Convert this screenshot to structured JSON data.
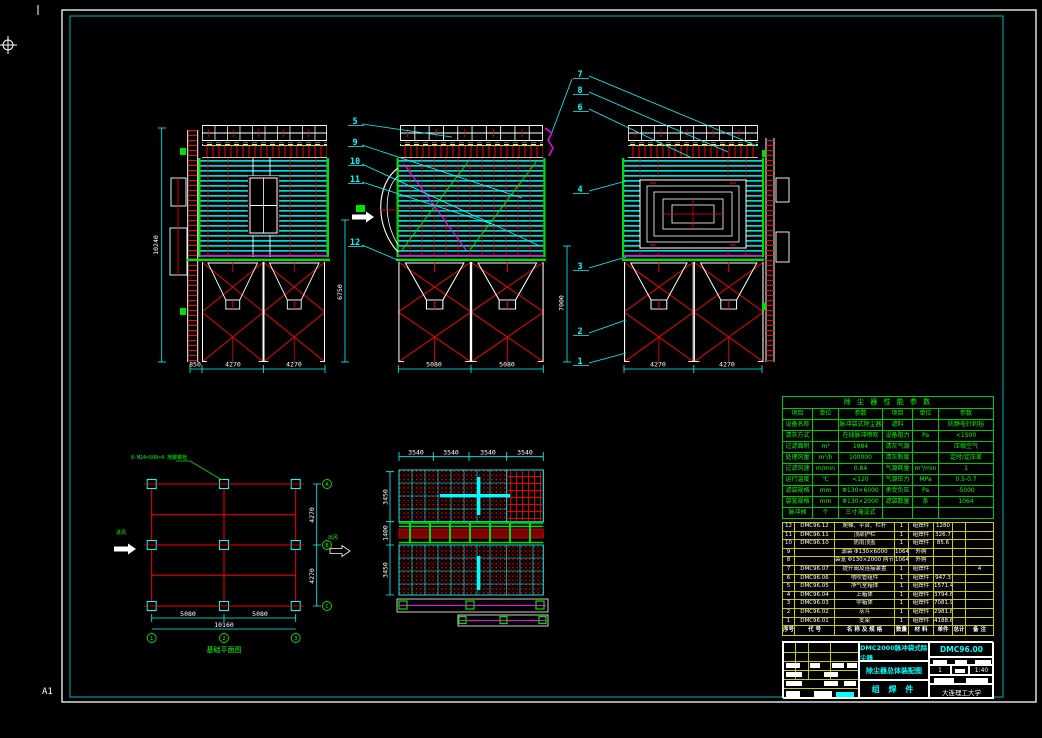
{
  "app": {
    "sheet_label": "A1"
  },
  "callouts": {
    "c1": "1",
    "c2": "2",
    "c3": "3",
    "c4": "4",
    "c5": "5",
    "c6": "6",
    "c7": "7",
    "c8": "8",
    "c9": "9",
    "c10": "10",
    "c11": "11",
    "c12": "12"
  },
  "dims": {
    "front_height": "10240",
    "front_lower_height": "6750",
    "middle_lower_height": "7000",
    "front_bottom": [
      "850",
      "4270",
      "4270"
    ],
    "middle_bottom": [
      "5080",
      "5080"
    ],
    "side_bottom": [
      "4270",
      "4270"
    ],
    "plan_top": [
      "3540",
      "3540",
      "3540",
      "3540"
    ],
    "plan_left": [
      "3450",
      "1400",
      "3450"
    ],
    "foundation_bottom": [
      "5080",
      "5080"
    ],
    "foundation_total": "10160",
    "foundation_right": [
      "4270",
      "4270"
    ]
  },
  "foundation": {
    "note": "8-M24×500×4 地脚螺栓",
    "caption": "基础平面图",
    "inlet": "进风",
    "outlet": "出风",
    "axes_bottom": [
      "1",
      "2",
      "3"
    ],
    "axes_right": [
      "A",
      "B",
      "C"
    ]
  },
  "spec_table": {
    "title": "除 尘 器 性 能 参 数",
    "headers": [
      "项目",
      "单位",
      "参数",
      "项目",
      "单位",
      "参数"
    ],
    "rows": [
      [
        "设备名称",
        "",
        "脉冲袋式除尘器",
        "滤料",
        "",
        "防静电针刺毡"
      ],
      [
        "清灰方式",
        "",
        "在线脉冲喷吹",
        "设备阻力",
        "Pa",
        "<1500"
      ],
      [
        "过滤面积",
        "m²",
        "1984",
        "清灰气源",
        "",
        "压缩空气"
      ],
      [
        "处理风量",
        "m³/h",
        "100000",
        "清灰制度",
        "",
        "定时/定压差"
      ],
      [
        "过滤风速",
        "m/min",
        "0.84",
        "气源耗量",
        "m³/min",
        "1"
      ],
      [
        "运行温度",
        "℃",
        "<120",
        "气源压力",
        "MPa",
        "0.5-0.7"
      ],
      [
        "滤袋规格",
        "mm",
        "Φ130×6000",
        "承受负压",
        "Pa",
        "-5000"
      ],
      [
        "袋笼规格",
        "mm",
        "Φ130×2000",
        "滤袋数量",
        "条",
        "1064"
      ],
      [
        "脉冲阀",
        "个",
        "三寸淹没式",
        "",
        "",
        ""
      ]
    ]
  },
  "bom": {
    "headers": [
      "序号",
      "代 号",
      "名 称 及 规 格",
      "数量",
      "材 料",
      "单件",
      "总计",
      "备 注"
    ],
    "rows": [
      [
        "12",
        "DMC96.12",
        "爬梯、平台、栏杆",
        "1",
        "组焊件",
        "1280",
        "",
        ""
      ],
      [
        "11",
        "DMC96.11",
        "顶部护栏",
        "1",
        "组焊件",
        "326.7",
        "",
        ""
      ],
      [
        "10",
        "DMC96.10",
        "防雨顶盖",
        "1",
        "组焊件",
        "85.6",
        "",
        ""
      ],
      [
        "9",
        "",
        "滤袋 Φ130×6000",
        "1064",
        "外购",
        "",
        "",
        ""
      ],
      [
        "8",
        "",
        "袋笼 Φ130×2000 两节式",
        "1064",
        "外购",
        "",
        "",
        ""
      ],
      [
        "7",
        "DMC96.07",
        "提升阀及连接装置",
        "1",
        "组焊件",
        "",
        "",
        "4"
      ],
      [
        "6",
        "DMC96.06",
        "喷吹管组件",
        "1",
        "组焊件",
        "947.3",
        "",
        ""
      ],
      [
        "5",
        "DMC96.05",
        "净气室箱体",
        "1",
        "组焊件",
        "1571.4",
        "",
        ""
      ],
      [
        "4",
        "DMC96.04",
        "上箱体",
        "1",
        "组焊件",
        "3794.6",
        "",
        ""
      ],
      [
        "3",
        "DMC96.03",
        "中箱体",
        "1",
        "组焊件",
        "7081.9",
        "",
        ""
      ],
      [
        "2",
        "DMC96.02",
        "灰斗",
        "1",
        "组焊件",
        "2981.8",
        "",
        ""
      ],
      [
        "1",
        "DMC96.01",
        "支架",
        "1",
        "组焊件",
        "4188.6",
        "",
        ""
      ]
    ]
  },
  "title_block": {
    "product_name": "DMC2000脉冲袋式除尘器",
    "drawing_title": "除尘器总体装配图",
    "part_type": "组 焊 件",
    "drawing_no": "DMC96.00",
    "stage_value": "1",
    "scale": "1:40",
    "org": "大连理工大学"
  }
}
